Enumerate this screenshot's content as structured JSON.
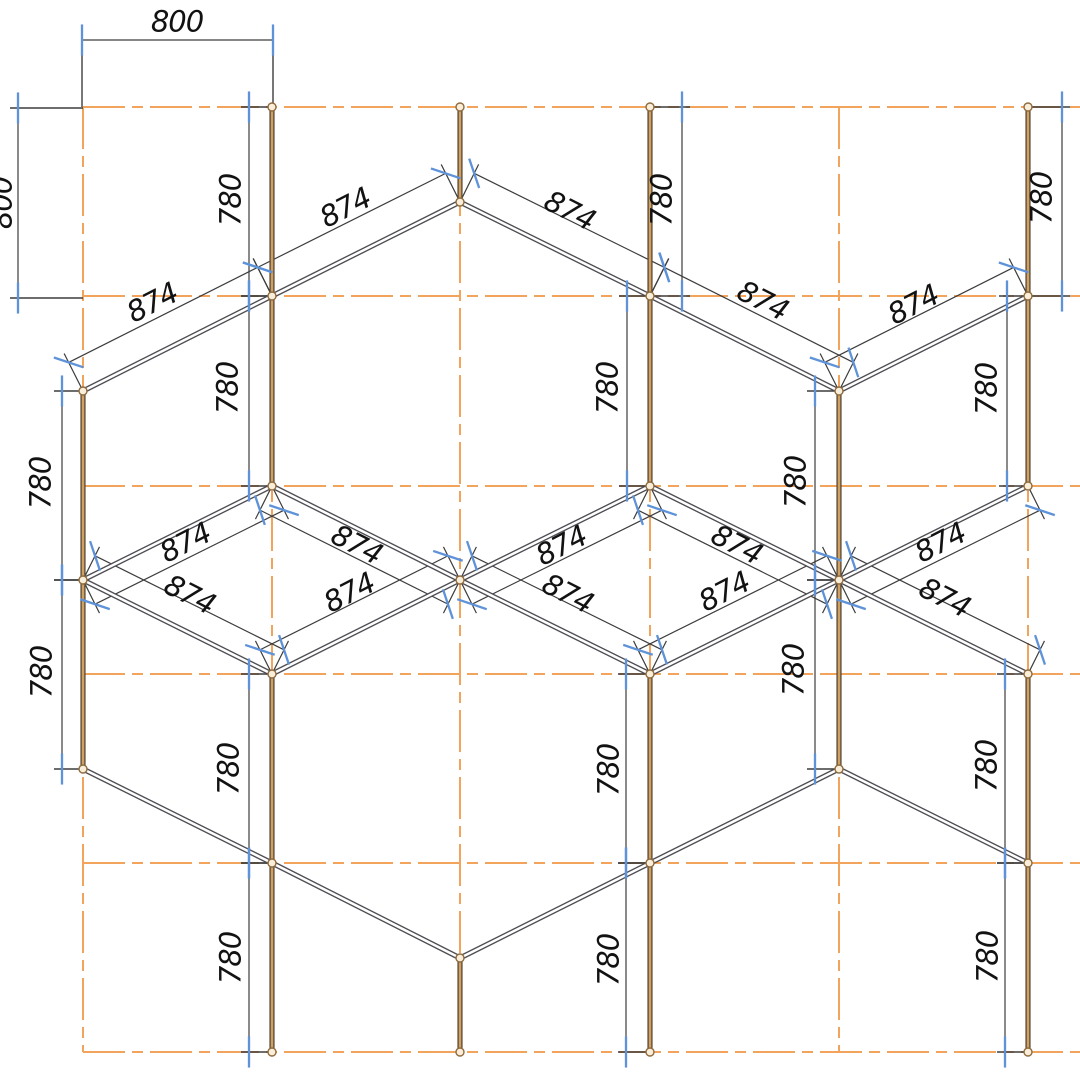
{
  "drawing": {
    "title": "hex-lattice-dimensioned-cad-drawing",
    "canvas": {
      "width": 1080,
      "height": 1080,
      "background": "#ffffff"
    },
    "colors": {
      "grid": "#f2a45c",
      "dim_line": "#3d3d3d",
      "tick": "#5e92d9",
      "text": "#121212",
      "vertical_member_outer": "#5c4b39",
      "vertical_member_core": "#cfa05f",
      "diagonal_member_outer": "#4e4d53",
      "diagonal_member_core": "#ffffff",
      "node_stroke": "#8f6b3e",
      "node_fill": "#f8eed9"
    },
    "grid": {
      "columns": [
        83,
        272,
        460,
        650,
        839,
        1028
      ],
      "rows": [
        107,
        296,
        486,
        674,
        863,
        1052
      ],
      "h_extent": [
        83,
        1080
      ],
      "v_extent": [
        107,
        1052
      ],
      "dash": [
        42,
        7,
        11,
        7
      ]
    },
    "members": {
      "verticals": [
        {
          "x": 272,
          "y1": 107,
          "y2": 486
        },
        {
          "x": 272,
          "y1": 674,
          "y2": 1052
        },
        {
          "x": 650,
          "y1": 107,
          "y2": 486
        },
        {
          "x": 650,
          "y1": 674,
          "y2": 1052
        },
        {
          "x": 1028,
          "y1": 107,
          "y2": 486
        },
        {
          "x": 1028,
          "y1": 674,
          "y2": 1052
        },
        {
          "x": 460,
          "y1": 107,
          "y2": 202
        },
        {
          "x": 460,
          "y1": 958,
          "y2": 1052
        },
        {
          "x": 83,
          "y1": 391,
          "y2": 769
        },
        {
          "x": 839,
          "y1": 391,
          "y2": 769
        }
      ],
      "diagonals": [
        {
          "x1": 460,
          "y1": 202,
          "x2": 272,
          "y2": 296
        },
        {
          "x1": 460,
          "y1": 202,
          "x2": 650,
          "y2": 296
        },
        {
          "x1": 272,
          "y1": 296,
          "x2": 83,
          "y2": 391
        },
        {
          "x1": 650,
          "y1": 296,
          "x2": 839,
          "y2": 391
        },
        {
          "x1": 1028,
          "y1": 296,
          "x2": 839,
          "y2": 391
        },
        {
          "x1": 272,
          "y1": 486,
          "x2": 83,
          "y2": 580
        },
        {
          "x1": 272,
          "y1": 486,
          "x2": 460,
          "y2": 580
        },
        {
          "x1": 650,
          "y1": 486,
          "x2": 460,
          "y2": 580
        },
        {
          "x1": 650,
          "y1": 486,
          "x2": 839,
          "y2": 580
        },
        {
          "x1": 1028,
          "y1": 486,
          "x2": 839,
          "y2": 580
        },
        {
          "x1": 83,
          "y1": 580,
          "x2": 272,
          "y2": 674
        },
        {
          "x1": 460,
          "y1": 580,
          "x2": 272,
          "y2": 674
        },
        {
          "x1": 460,
          "y1": 580,
          "x2": 650,
          "y2": 674
        },
        {
          "x1": 839,
          "y1": 580,
          "x2": 650,
          "y2": 674
        },
        {
          "x1": 839,
          "y1": 580,
          "x2": 1028,
          "y2": 674
        },
        {
          "x1": 83,
          "y1": 769,
          "x2": 272,
          "y2": 863
        },
        {
          "x1": 839,
          "y1": 769,
          "x2": 650,
          "y2": 863
        },
        {
          "x1": 839,
          "y1": 769,
          "x2": 1028,
          "y2": 863
        },
        {
          "x1": 272,
          "y1": 863,
          "x2": 460,
          "y2": 958
        },
        {
          "x1": 650,
          "y1": 863,
          "x2": 460,
          "y2": 958
        }
      ],
      "nodes": [
        [
          272,
          107
        ],
        [
          272,
          296
        ],
        [
          272,
          486
        ],
        [
          272,
          674
        ],
        [
          272,
          863
        ],
        [
          272,
          1052
        ],
        [
          650,
          107
        ],
        [
          650,
          296
        ],
        [
          650,
          486
        ],
        [
          650,
          674
        ],
        [
          650,
          863
        ],
        [
          650,
          1052
        ],
        [
          1028,
          107
        ],
        [
          1028,
          296
        ],
        [
          1028,
          486
        ],
        [
          1028,
          674
        ],
        [
          1028,
          863
        ],
        [
          1028,
          1052
        ],
        [
          460,
          107
        ],
        [
          460,
          202
        ],
        [
          460,
          580
        ],
        [
          460,
          958
        ],
        [
          460,
          1052
        ],
        [
          83,
          391
        ],
        [
          83,
          580
        ],
        [
          83,
          769
        ],
        [
          839,
          391
        ],
        [
          839,
          580
        ],
        [
          839,
          769
        ]
      ]
    },
    "dimensions": {
      "horizontal": [
        {
          "value": "800",
          "y": 40,
          "x1": 82,
          "x2": 273,
          "ext_to": [
            107,
            103
          ],
          "label": {
            "x": 177,
            "y": 21,
            "rot": 0
          }
        }
      ],
      "vertical": [
        {
          "value": "800",
          "x": 18,
          "y1": 108,
          "y2": 298,
          "member_x": 83,
          "label": {
            "x": 1,
            "y": 203,
            "rot": -90
          }
        },
        {
          "value": "780",
          "x": 249,
          "y1": 107,
          "y2": 296,
          "member_x": 272,
          "label": {
            "x": 230,
            "y": 200,
            "rot": -90
          }
        },
        {
          "value": "780",
          "x": 682,
          "y1": 107,
          "y2": 296,
          "member_x": 650,
          "label": {
            "x": 661,
            "y": 200,
            "rot": -90
          }
        },
        {
          "value": "780",
          "x": 1062,
          "y1": 107,
          "y2": 296,
          "member_x": 1028,
          "label": {
            "x": 1041,
            "y": 198,
            "rot": -90
          }
        },
        {
          "value": "780",
          "x": 249,
          "y1": 296,
          "y2": 486,
          "member_x": 272,
          "label": {
            "x": 227,
            "y": 388,
            "rot": -90
          }
        },
        {
          "value": "780",
          "x": 627,
          "y1": 296,
          "y2": 486,
          "member_x": 650,
          "label": {
            "x": 607,
            "y": 388,
            "rot": -90
          }
        },
        {
          "value": "780",
          "x": 1007,
          "y1": 296,
          "y2": 486,
          "member_x": 1028,
          "label": {
            "x": 986,
            "y": 389,
            "rot": -90
          }
        },
        {
          "value": "780",
          "x": 62,
          "y1": 391,
          "y2": 580,
          "member_x": 83,
          "label": {
            "x": 40,
            "y": 483,
            "rot": -90
          }
        },
        {
          "value": "780",
          "x": 815,
          "y1": 391,
          "y2": 580,
          "member_x": 839,
          "label": {
            "x": 795,
            "y": 482,
            "rot": -90
          }
        },
        {
          "value": "780",
          "x": 62,
          "y1": 580,
          "y2": 769,
          "member_x": 83,
          "label": {
            "x": 41,
            "y": 672,
            "rot": -90
          }
        },
        {
          "value": "780",
          "x": 815,
          "y1": 580,
          "y2": 769,
          "member_x": 839,
          "label": {
            "x": 793,
            "y": 670,
            "rot": -90
          }
        },
        {
          "value": "780",
          "x": 249,
          "y1": 674,
          "y2": 863,
          "member_x": 272,
          "label": {
            "x": 228,
            "y": 769,
            "rot": -90
          }
        },
        {
          "value": "780",
          "x": 626,
          "y1": 674,
          "y2": 863,
          "member_x": 650,
          "label": {
            "x": 608,
            "y": 770,
            "rot": -90
          }
        },
        {
          "value": "780",
          "x": 1005,
          "y1": 674,
          "y2": 863,
          "member_x": 1028,
          "label": {
            "x": 986,
            "y": 766,
            "rot": -90
          }
        },
        {
          "value": "780",
          "x": 249,
          "y1": 863,
          "y2": 1052,
          "member_x": 272,
          "label": {
            "x": 230,
            "y": 958,
            "rot": -90
          }
        },
        {
          "value": "780",
          "x": 626,
          "y1": 863,
          "y2": 1052,
          "member_x": 650,
          "label": {
            "x": 608,
            "y": 960,
            "rot": -90
          }
        },
        {
          "value": "780",
          "x": 1005,
          "y1": 863,
          "y2": 1052,
          "member_x": 1028,
          "label": {
            "x": 987,
            "y": 957,
            "rot": -90
          }
        }
      ],
      "aligned": [
        {
          "value": "874",
          "ax": 460,
          "ay": 202,
          "bx": 272,
          "by": 296,
          "side": -1,
          "offset": 32,
          "label": {
            "x": 345,
            "y": 207,
            "rot": -27
          }
        },
        {
          "value": "874",
          "ax": 460,
          "ay": 202,
          "bx": 650,
          "by": 296,
          "side": -1,
          "offset": 32,
          "label": {
            "x": 570,
            "y": 210,
            "rot": 27
          }
        },
        {
          "value": "874",
          "ax": 272,
          "ay": 296,
          "bx": 83,
          "by": 391,
          "side": -1,
          "offset": 32,
          "label": {
            "x": 152,
            "y": 302,
            "rot": -27
          }
        },
        {
          "value": "874",
          "ax": 650,
          "ay": 296,
          "bx": 839,
          "by": 391,
          "side": -1,
          "offset": 32,
          "label": {
            "x": 763,
            "y": 300,
            "rot": 27
          }
        },
        {
          "value": "874",
          "ax": 1028,
          "ay": 296,
          "bx": 839,
          "by": 391,
          "side": -1,
          "offset": 32,
          "label": {
            "x": 913,
            "y": 304,
            "rot": -27
          }
        },
        {
          "value": "874",
          "ax": 272,
          "ay": 486,
          "bx": 83,
          "by": 580,
          "side": 1,
          "offset": 27,
          "label": {
            "x": 185,
            "y": 542,
            "rot": -27
          }
        },
        {
          "value": "874",
          "ax": 272,
          "ay": 486,
          "bx": 460,
          "by": 580,
          "side": 1,
          "offset": 27,
          "label": {
            "x": 357,
            "y": 544,
            "rot": 27
          }
        },
        {
          "value": "874",
          "ax": 650,
          "ay": 486,
          "bx": 460,
          "by": 580,
          "side": 1,
          "offset": 27,
          "label": {
            "x": 561,
            "y": 545,
            "rot": -27
          }
        },
        {
          "value": "874",
          "ax": 650,
          "ay": 486,
          "bx": 839,
          "by": 580,
          "side": 1,
          "offset": 27,
          "label": {
            "x": 737,
            "y": 544,
            "rot": 27
          }
        },
        {
          "value": "874",
          "ax": 1028,
          "ay": 486,
          "bx": 839,
          "by": 580,
          "side": 1,
          "offset": 27,
          "label": {
            "x": 940,
            "y": 542,
            "rot": -27
          }
        },
        {
          "value": "874",
          "ax": 83,
          "ay": 580,
          "bx": 272,
          "by": 674,
          "side": -1,
          "offset": 27,
          "label": {
            "x": 190,
            "y": 594,
            "rot": 27
          }
        },
        {
          "value": "874",
          "ax": 460,
          "ay": 580,
          "bx": 272,
          "by": 674,
          "side": -1,
          "offset": 27,
          "label": {
            "x": 349,
            "y": 592,
            "rot": -27
          }
        },
        {
          "value": "874",
          "ax": 460,
          "ay": 580,
          "bx": 650,
          "by": 674,
          "side": -1,
          "offset": 27,
          "label": {
            "x": 568,
            "y": 593,
            "rot": 27
          }
        },
        {
          "value": "874",
          "ax": 839,
          "ay": 580,
          "bx": 650,
          "by": 674,
          "side": -1,
          "offset": 27,
          "label": {
            "x": 724,
            "y": 591,
            "rot": -27
          }
        },
        {
          "value": "874",
          "ax": 839,
          "ay": 580,
          "bx": 1028,
          "by": 674,
          "side": -1,
          "offset": 27,
          "label": {
            "x": 945,
            "y": 597,
            "rot": 27
          }
        }
      ]
    },
    "label_font_px": 29
  }
}
